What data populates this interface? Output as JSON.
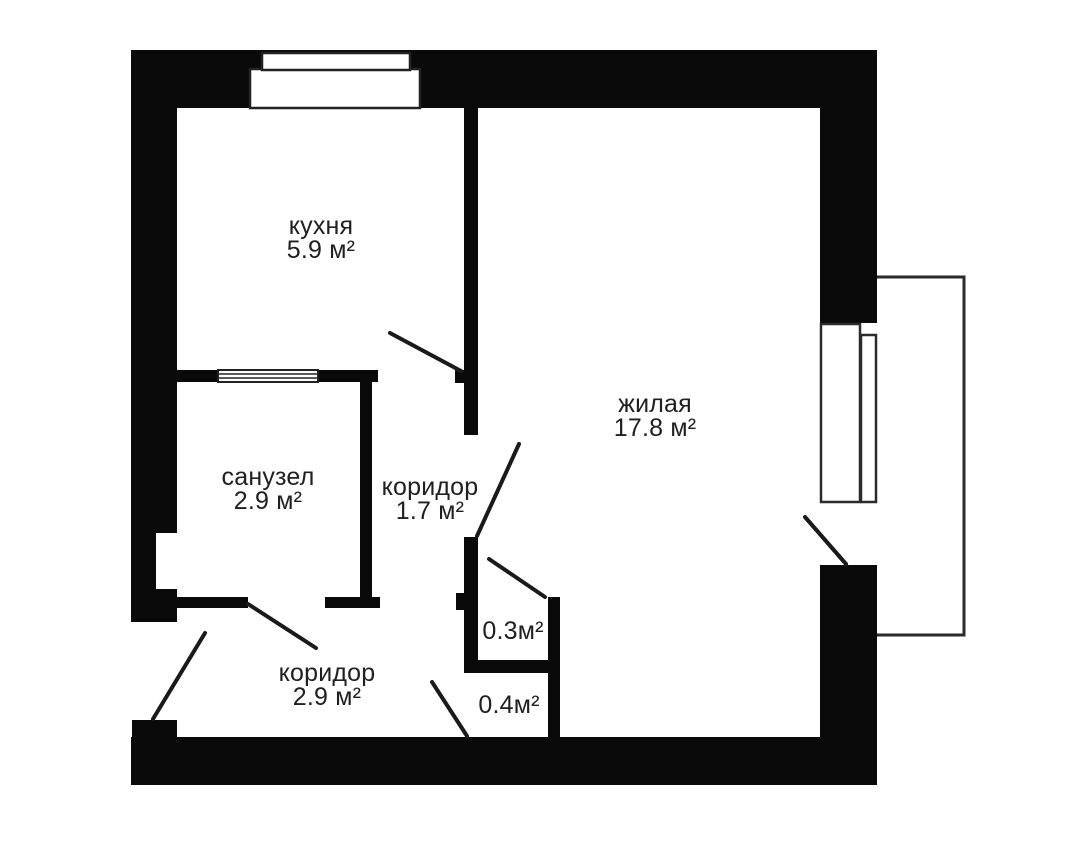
{
  "plan": {
    "colors": {
      "wall": "#0a0a0a",
      "text": "#202020",
      "thin_line": "#2b2b2b",
      "background": "#ffffff"
    },
    "rooms": [
      {
        "name": "кухня",
        "area": "5.9 м²"
      },
      {
        "name": "санузел",
        "area": "2.9 м²"
      },
      {
        "name": "коридор",
        "area": "1.7 м²"
      },
      {
        "name": "жилая",
        "area": "17.8 м²"
      },
      {
        "name": "коридор",
        "area": "2.9 м²"
      }
    ],
    "closets": [
      {
        "area": "0.3м²"
      },
      {
        "area": "0.4м²"
      }
    ]
  }
}
